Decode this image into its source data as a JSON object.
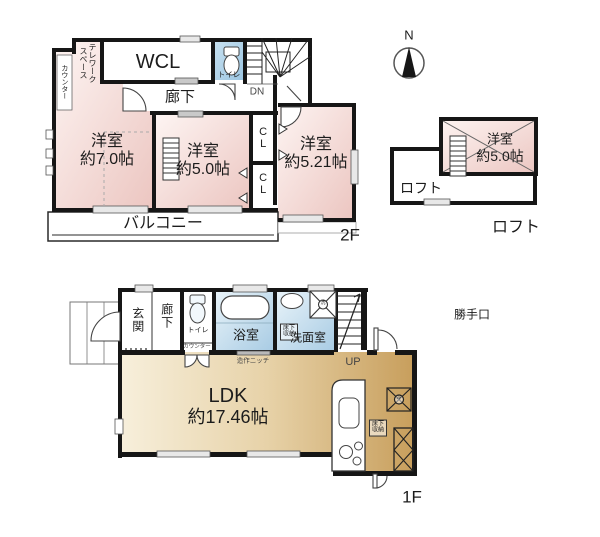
{
  "plan_title": "2-story house floor plan with loft",
  "colors": {
    "wall": "#161616",
    "room_pink": "#ecc6c1",
    "wet_area_blue": "#a9cce4",
    "toilet_blue": "#9cc6e2",
    "ldk_tan": "#c89f5d",
    "floor_white": "#ffffff"
  },
  "floors": {
    "second": {
      "name_label": "2F",
      "rooms": {
        "counter": "カウンター",
        "telework": "テレワーク\nスペース",
        "wcl": "WCL",
        "toilet": "トイレ",
        "stairs_dn": "DN",
        "hallway": "廊下",
        "bedroom7": {
          "name": "洋室",
          "size": "約7.0帖"
        },
        "bedroom5": {
          "name": "洋室",
          "size": "約5.0帖"
        },
        "closet1": "CL",
        "closet2": "CL",
        "bedroom521": {
          "name": "洋室",
          "size": "約5.21帖"
        },
        "balcony": "バルコニー"
      }
    },
    "loft": {
      "name_label": "ロフト",
      "compass_n": "N",
      "rooms": {
        "bedroom5": {
          "name": "洋室",
          "size": "約5.0帖"
        },
        "loft_space": "ロフト"
      }
    },
    "first": {
      "name_label": "1F",
      "rooms": {
        "entrance": "玄関",
        "hallway": "廊下",
        "toilet": "トイレ",
        "counter": "カウンター",
        "bathroom": "浴室",
        "underfloor_storage_wash": "床下\n収納",
        "washroom": "洗面室",
        "washer_mark": "洗",
        "stairs_up": "UP",
        "back_door": "勝手口",
        "niche": "造作ニッチ",
        "ldk": {
          "name": "LDK",
          "size": "約17.46帖"
        },
        "underfloor_storage_kitchen": "床下\n収納",
        "fridge_mark": "冷"
      }
    }
  }
}
